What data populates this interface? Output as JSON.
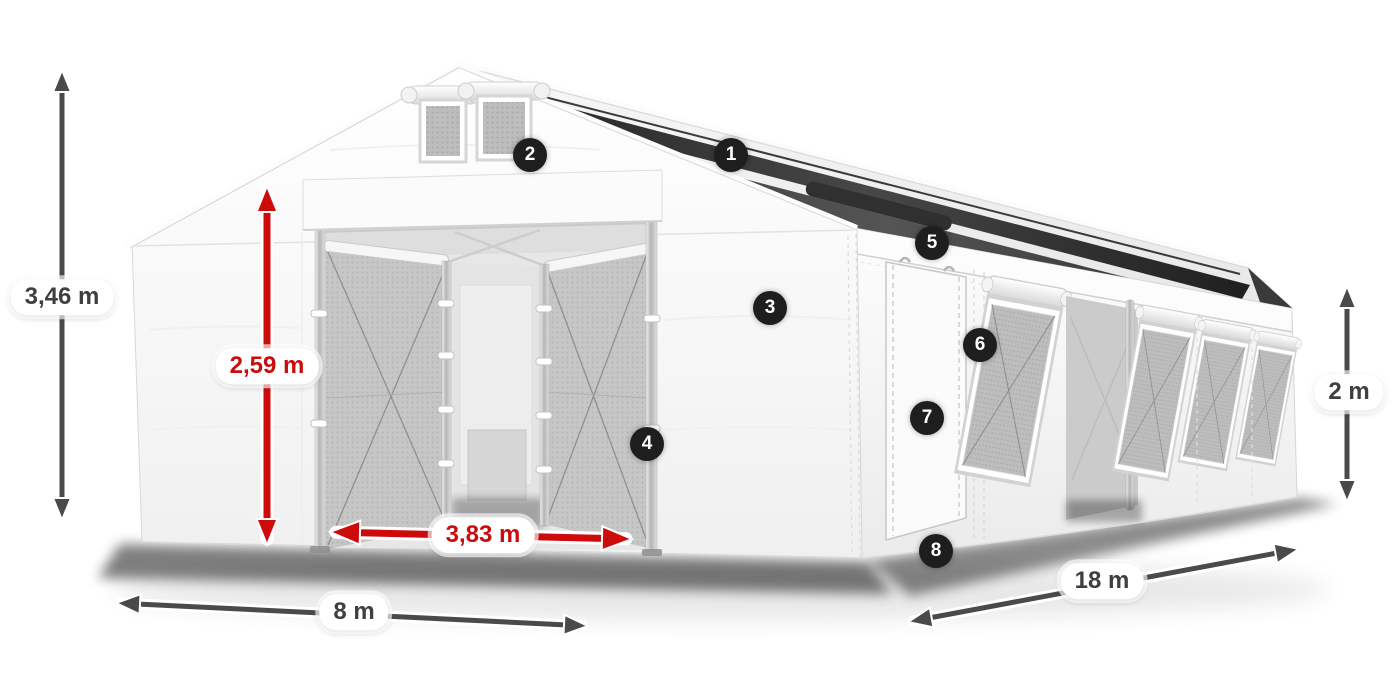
{
  "dimensions": {
    "total_height": "3,46 m",
    "entrance_height": "2,59 m",
    "entrance_width": "3,83 m",
    "width": "8 m",
    "length": "18 m",
    "side_wall_height": "2 m"
  },
  "callouts": [
    "1",
    "2",
    "3",
    "4",
    "5",
    "6",
    "7",
    "8"
  ],
  "colors": {
    "dimension_arrow": "#4a4a4a",
    "highlight_arrow": "#ce0b0b",
    "highlight_label_text": "#c90c0c",
    "label_text": "#3f3f3f",
    "label_background": "#ffffff",
    "badge_background": "#1e1e1e",
    "badge_text": "#ffffff",
    "tent_fabric": "#f7f7f7",
    "mesh_panel": "#c6c6c6",
    "roof_skylight_strip": "#2b2b2b"
  }
}
